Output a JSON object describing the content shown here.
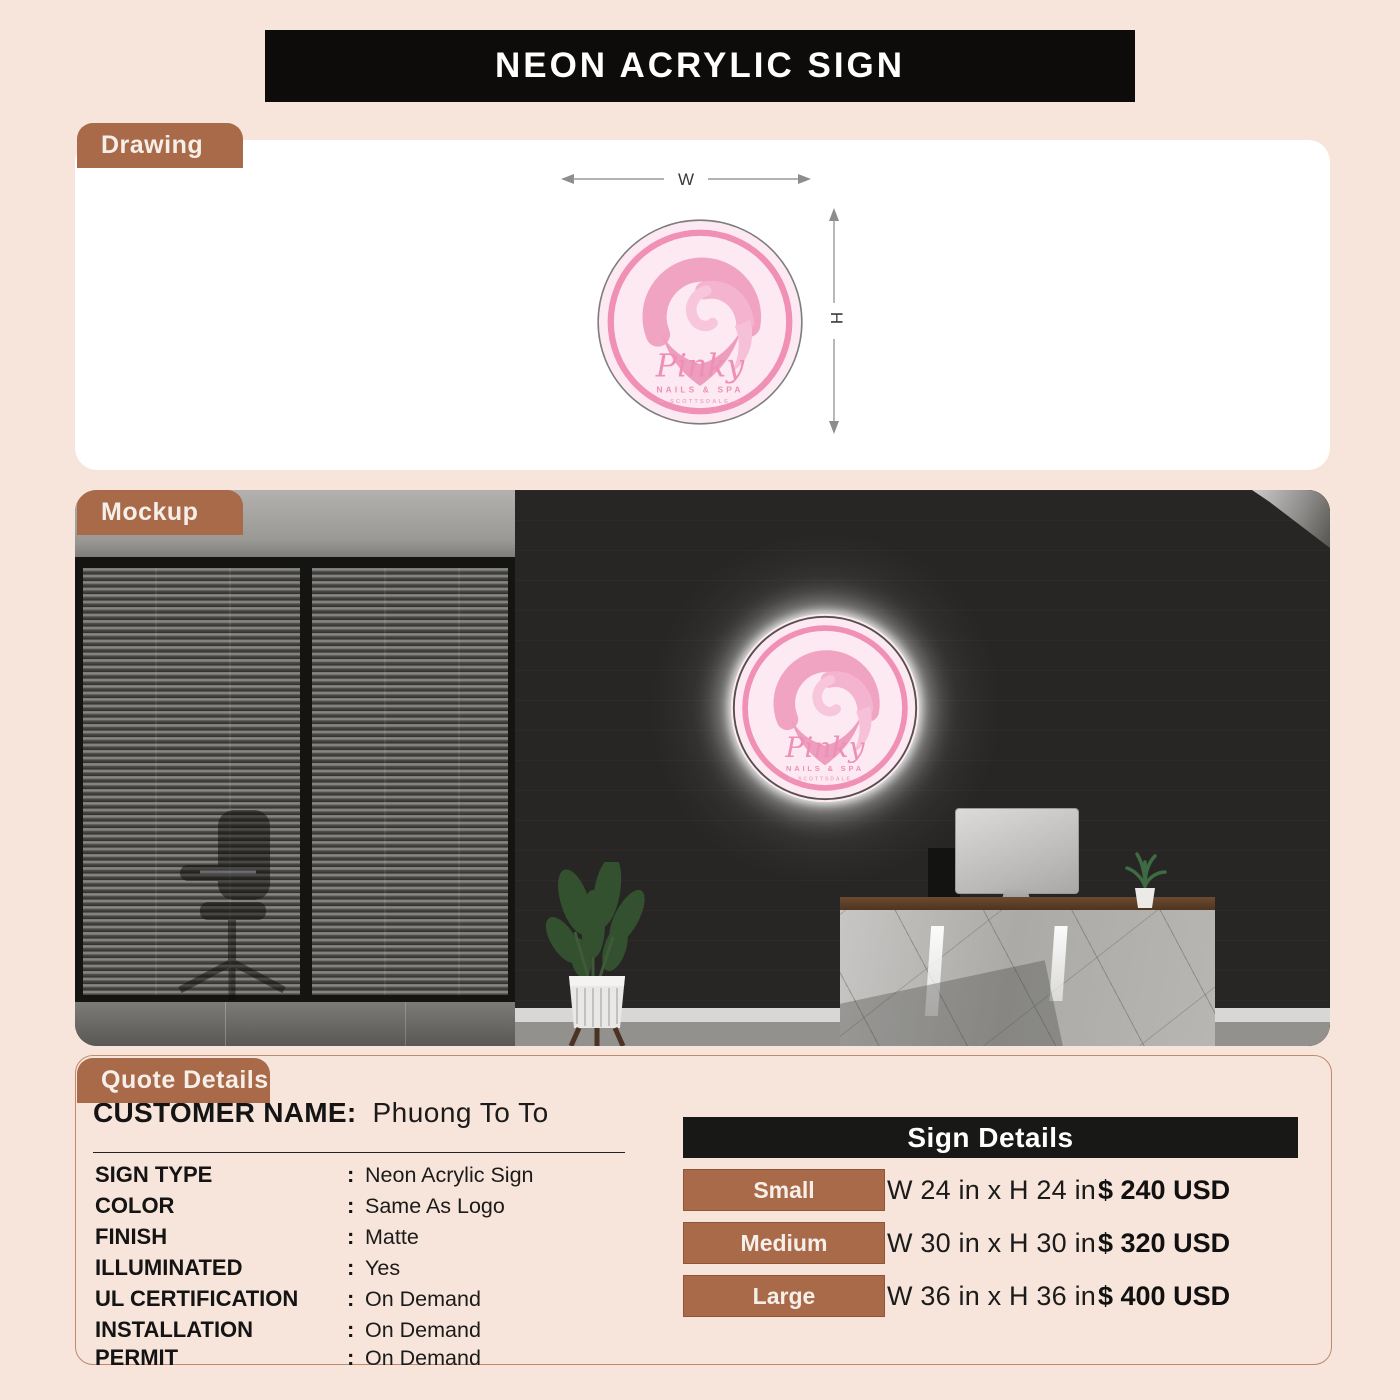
{
  "page": {
    "title": "NEON ACRYLIC SIGN",
    "bg_color": "#f7e4da",
    "accent_brown": "#a86a48",
    "banner_black": "#0d0c0a",
    "logo_pink": "#f090b5"
  },
  "sections": {
    "drawing_label": "Drawing",
    "mockup_label": "Mockup",
    "quote_label": "Quote Details"
  },
  "drawing": {
    "width_label": "W",
    "height_label": "H"
  },
  "logo": {
    "name": "Pinky",
    "subtitle": "NAILS & SPA",
    "tagline": "— SCOTTSDALE —"
  },
  "quote": {
    "customer_label": "CUSTOMER NAME:",
    "customer_name": "Phuong To To",
    "colon": ":",
    "specs": [
      {
        "label": "SIGN TYPE",
        "value": "Neon Acrylic Sign"
      },
      {
        "label": "COLOR",
        "value": "Same As Logo"
      },
      {
        "label": "FINISH",
        "value": "Matte"
      },
      {
        "label": "ILLUMINATED",
        "value": "Yes"
      },
      {
        "label": "UL CERTIFICATION",
        "value": "On Demand"
      },
      {
        "label": "INSTALLATION",
        "value": "On Demand"
      },
      {
        "label": "PERMIT",
        "value": "On Demand"
      }
    ],
    "sign_details": {
      "title": "Sign Details",
      "rows": [
        {
          "size": "Small",
          "dimensions": "W 24 in x H 24 in",
          "price": "$ 240 USD"
        },
        {
          "size": "Medium",
          "dimensions": "W 30 in x H 30 in",
          "price": "$ 320 USD"
        },
        {
          "size": "Large",
          "dimensions": "W 36 in x H 36 in",
          "price": "$ 400 USD"
        }
      ]
    }
  }
}
